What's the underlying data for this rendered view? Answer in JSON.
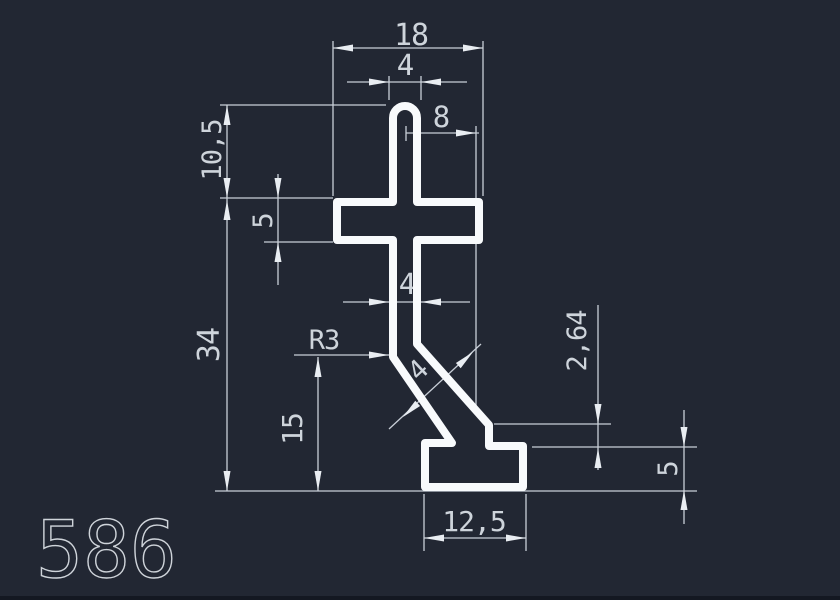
{
  "drawing": {
    "title": "profile-cross-section",
    "part_number": "586",
    "dimensions": {
      "overall_width": "18",
      "stem_width_top": "4",
      "offset_width": "8",
      "cap_height": "10,5",
      "arm_thickness": "5",
      "profile_height": "34",
      "stem_width_mid": "4",
      "fillet_radius": "R3",
      "strut_thickness": "4",
      "leg_height": "15",
      "step_height": "2,64",
      "base_thickness": "5",
      "base_width": "12,5"
    },
    "colors": {
      "background": "#222733",
      "line": "#c9cfd8",
      "profile": "#f8fafc",
      "text": "#ced4db"
    }
  }
}
